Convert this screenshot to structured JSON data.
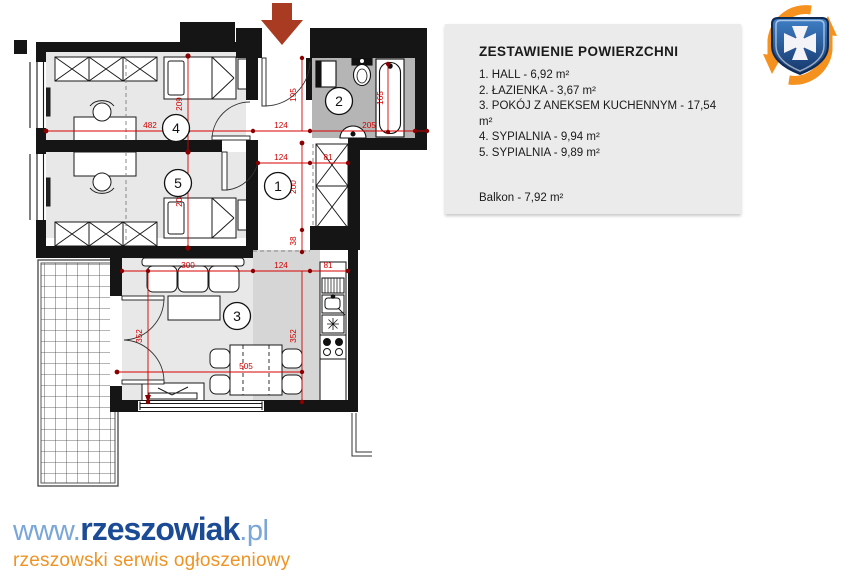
{
  "legend": {
    "title": "ZESTAWIENIE POWIERZCHNI",
    "items": [
      "1. HALL - 6,92 m²",
      "2. ŁAZIENKA - 3,67 m²",
      "3. POKÓJ Z ANEKSEM KUCHENNYM - 17,54 m²",
      "4. SYPIALNIA - 9,94 m²",
      "5. SYPIALNIA - 9,89 m²"
    ],
    "balcony": "Balkon - 7,92 m²"
  },
  "plan": {
    "room_numbers": {
      "hall": "1",
      "bathroom": "2",
      "living": "3",
      "bedroom_top": "4",
      "bedroom_left": "5"
    },
    "dims": {
      "d482": "482",
      "d209": "209",
      "d208": "208",
      "d124_top": "124",
      "d205": "205",
      "d165": "165",
      "d195": "195",
      "d124_hall": "124",
      "d81_hall": "81",
      "d200": "200",
      "d38": "38",
      "d300": "300",
      "d124_kitchen": "124",
      "d81_kitchen": "81",
      "d352_left": "352",
      "d352_right": "352",
      "d505": "505"
    },
    "colors": {
      "wall": "#151515",
      "dim_red": "#d40000",
      "entry_arrow": "#a83b22",
      "room_fill": "#e8e8e8",
      "bath_fill": "#b5b5b5",
      "kitchen_fill": "#d6d6d6"
    }
  },
  "footer": {
    "www": "www.",
    "brand": "rzeszowiak",
    "tld": ".pl",
    "tagline": "rzeszowski serwis ogłoszeniowy"
  },
  "logo": {
    "name": "rzeszowiak-crest"
  }
}
